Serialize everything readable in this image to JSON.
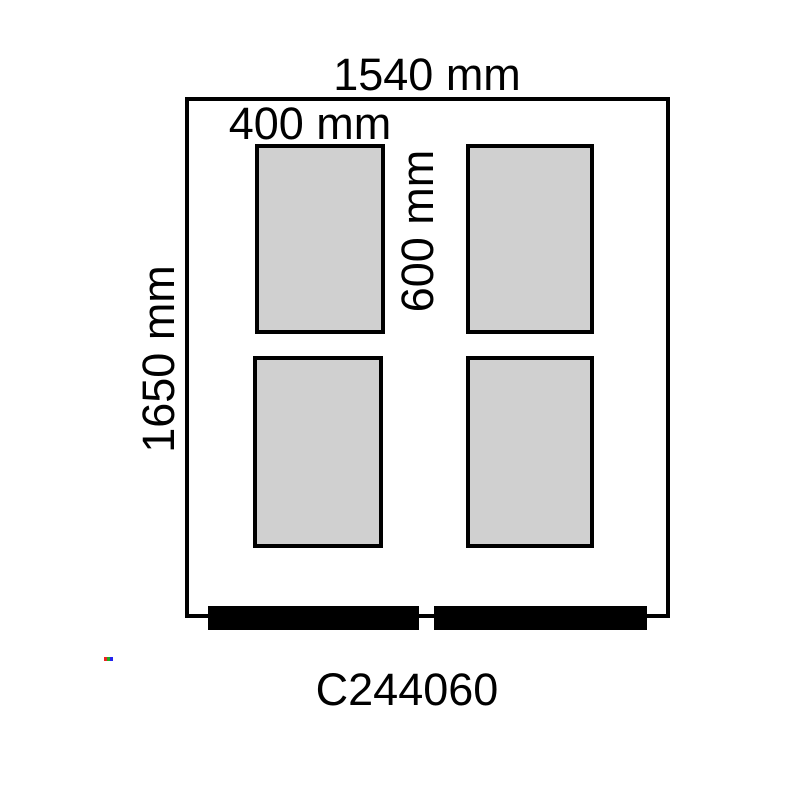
{
  "diagram": {
    "product_code": "C244060",
    "frame": {
      "width_label": "1540 mm",
      "height_label": "1650 mm"
    },
    "panel": {
      "width_label": "400 mm",
      "height_label": "600 mm",
      "count": 4,
      "rows": 2,
      "columns": 2
    },
    "colors": {
      "background": "#ffffff",
      "outline": "#000000",
      "panel_fill": "#d0d0d0",
      "bottom_bar_fill": "#000000",
      "artifact": [
        "#ee2222",
        "#22aa22",
        "#2222ee"
      ]
    }
  }
}
